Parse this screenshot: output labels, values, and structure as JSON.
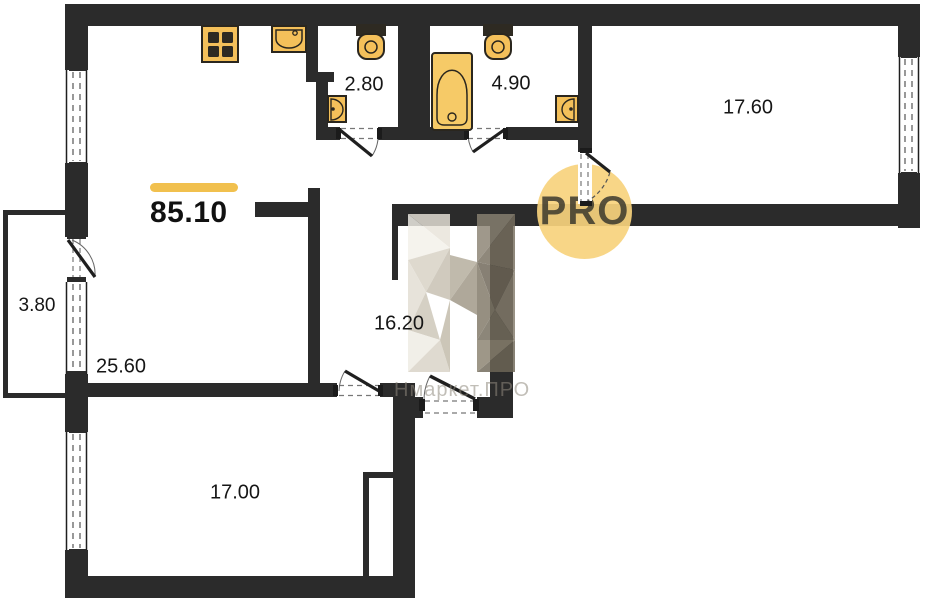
{
  "plan": {
    "total_area": "85.10",
    "badge_text": "PRO",
    "watermark_text": "Нмаркет.ПРО",
    "rooms": [
      {
        "id": "wc",
        "area": "2.80"
      },
      {
        "id": "bathroom",
        "area": "4.90"
      },
      {
        "id": "bedroom",
        "area": "17.60"
      },
      {
        "id": "balcony",
        "area": "3.80"
      },
      {
        "id": "kitchen-living-room",
        "area": "25.60"
      },
      {
        "id": "hallway",
        "area": "16.20"
      },
      {
        "id": "bedroom-2",
        "area": "17.00"
      }
    ],
    "colors": {
      "wall": "#2b2b2b",
      "fixture_fill": "#f4c05a",
      "accent_bar": "#f1c04e",
      "badge_fill": "#f7d37d",
      "label_text": "#161616"
    }
  }
}
